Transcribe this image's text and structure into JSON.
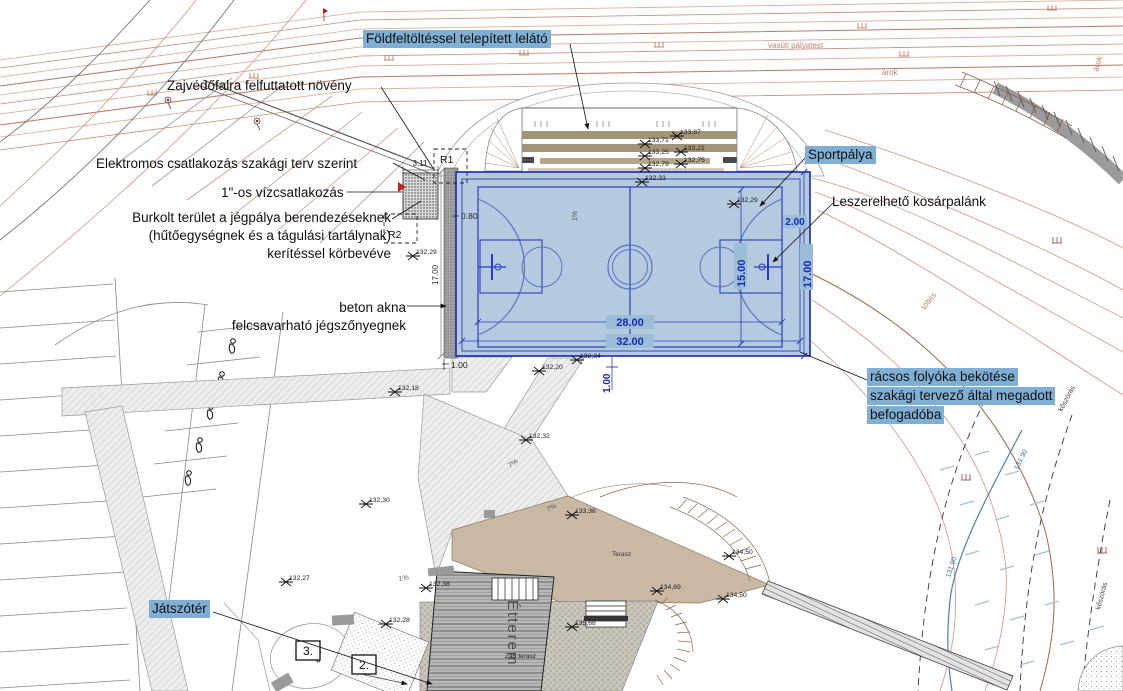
{
  "callouts": {
    "lelato": "Földfeltöltéssel telepített lelátó",
    "noveny": "Zajvédőfalra felfuttatott növény",
    "elektromos": "Elektromos csatlakozás szakági terv szerint",
    "vizcsatlakozas": "1\"-os vízcsatlakozás",
    "burkolt_line1": "Burkolt terület a jégpálya berendezéseknek",
    "burkolt_line2": "(hűtőegységnek és a tágulási tartálynak)",
    "burkolt_line3": "kerítéssel körbevéve",
    "beton_line1": "beton akna",
    "beton_line2": "felcsavarható jégszőnyegnek",
    "sportpalya": "Sportpálya",
    "kosarpalank": "Leszerelhető kosárpalánk",
    "folyoka_line1": "rácsos folyóka bekötése",
    "folyoka_line2": "szakági tervező által megadott",
    "folyoka_line3": "befogadóba",
    "jatszoter": "Játszótér"
  },
  "dimensions": {
    "court_length": "28.00",
    "court_total_length": "32.00",
    "court_width": "15.00",
    "court_total_width": "17.00",
    "court_total_width_left": "17.00",
    "basket_offset": "2.00",
    "apron_offset": "1.00",
    "drain_offset": "1.00",
    "pad_offset": "0.80",
    "pad_width": "3.11"
  },
  "map_labels": {
    "vasut": "vasúti pályatest",
    "arok_1": "árok",
    "arok_2": "árok",
    "toltes": "töltés",
    "koszoras_1": "kőszórás",
    "koszoras_2": "kőszórás",
    "stream_level_1": "131.90",
    "stream_level_2": "131.90",
    "terasz": "Terasz",
    "zart_terasz": "Zárt terasz",
    "etterem": "Étterem",
    "r1": "R1",
    "r2": "R2",
    "num_3": "3.",
    "num_2": "2.",
    "slope_7a": "7%",
    "slope_7b": "7%",
    "slope_1a": "1%",
    "slope_1b": "1%"
  },
  "elevations": [
    {
      "value": "133,71"
    },
    {
      "value": "133,87"
    },
    {
      "value": "133,25"
    },
    {
      "value": "133,21"
    },
    {
      "value": "132,79"
    },
    {
      "value": "132,75"
    },
    {
      "value": "132,33"
    },
    {
      "value": "132,29"
    },
    {
      "value": "132,29"
    },
    {
      "value": "132,34"
    },
    {
      "value": "132,20"
    },
    {
      "value": "132,18"
    },
    {
      "value": "132,32"
    },
    {
      "value": "132,30"
    },
    {
      "value": "133,38"
    },
    {
      "value": "134,50"
    },
    {
      "value": "134,69"
    },
    {
      "value": "134,50"
    },
    {
      "value": "132,38"
    },
    {
      "value": "135,68"
    },
    {
      "value": "132,28"
    },
    {
      "value": "132,27"
    }
  ],
  "colors": {
    "highlight": "#7fafd4",
    "court_fill": "#b5cade",
    "court_line": "#1a28b4",
    "contour": "#cf9583",
    "terrace_fill": "#c9b9a4",
    "stream": "#4a80b0"
  }
}
